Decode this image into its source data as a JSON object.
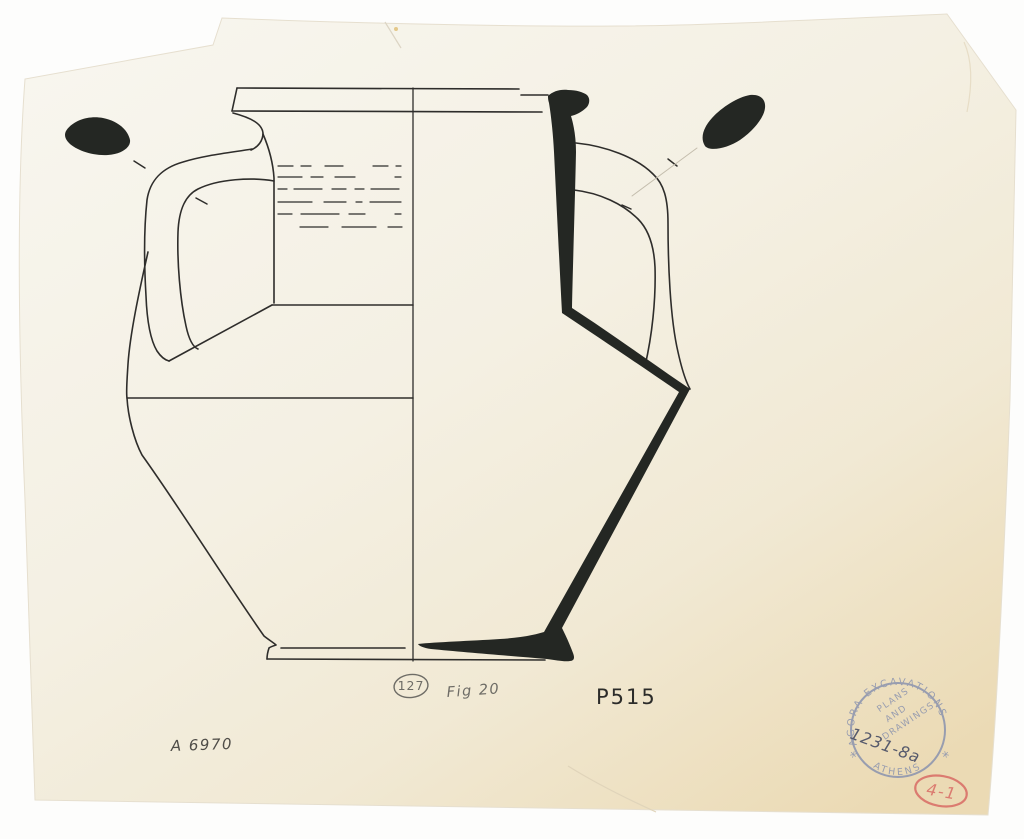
{
  "paper": {
    "top_color": "#f8f6ef",
    "bottom_color": "#ebdab4"
  },
  "drawing": {
    "ink_color": "#2e2d2b",
    "section_fill": "#242723"
  },
  "annotations": {
    "circled_number": "127",
    "figure_label": "Fig 20",
    "catalog_number": "P515",
    "inventory_number": "A 6970",
    "pencil_color": "#6e6c66",
    "pencil_dark": "#4f4d48",
    "ink_dark": "#2c2c2a"
  },
  "stamp": {
    "arc_top": "AGORA EXCAVATIONS",
    "arc_bottom": "ATHENS",
    "inner_line1": "PLANS",
    "inner_line2": "AND",
    "inner_line3": "DRAWINGS",
    "handwritten_number": "1231-8a",
    "star_left": "*",
    "star_right": "*",
    "ink_color": "#9198af",
    "number_color": "#4a4f66"
  },
  "red_mark": {
    "label": "4-1",
    "color": "#db7b70"
  }
}
